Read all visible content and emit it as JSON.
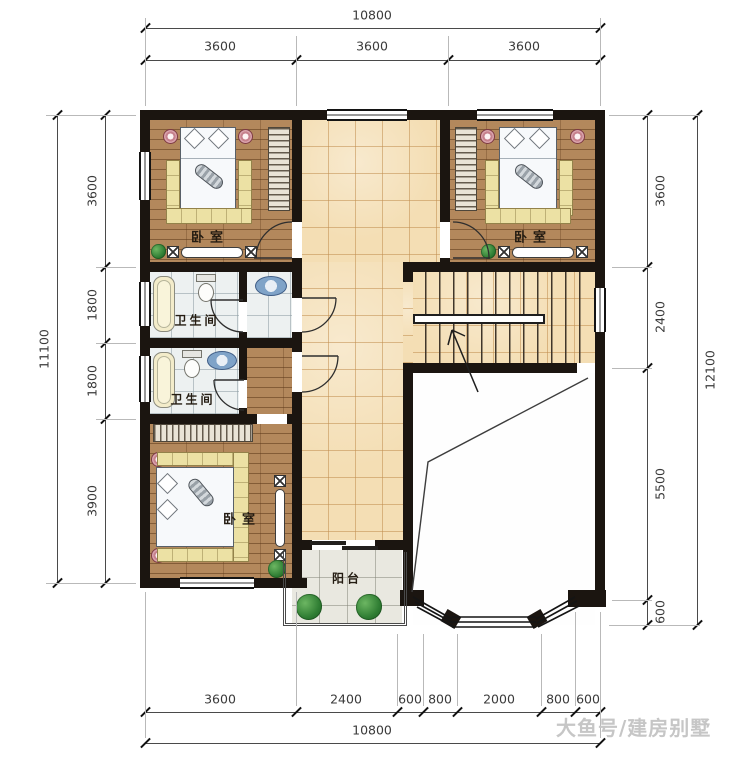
{
  "plan": {
    "title": "residential second floor plan",
    "watermark": "大鱼号/建房别墅",
    "rooms": {
      "bedroom_top_left": "卧室",
      "bedroom_top_right": "卧室",
      "bedroom_bottom_left": "卧室",
      "bathroom_upper": "卫生间",
      "bathroom_lower": "卫生间",
      "balcony": "阳台"
    },
    "dims": {
      "top": {
        "total": "10800",
        "segments": [
          "3600",
          "3600",
          "3600"
        ]
      },
      "bottom": {
        "total": "10800",
        "segments": [
          "3600",
          "2400",
          "600",
          "800",
          "2000",
          "800",
          "600"
        ]
      },
      "left": {
        "total": "11100",
        "segments": [
          "3600",
          "1800",
          "1800",
          "3900"
        ]
      },
      "right": {
        "total": "12100",
        "segments": [
          "3600",
          "2400",
          "5500",
          "600"
        ]
      }
    },
    "colors": {
      "wall": "#1b1510",
      "wood_floor": "#b3885c",
      "hall_tile": "#f4deb4",
      "bath_tile": "#edf1f1",
      "balcony_tile": "#e9e8e0",
      "bench_yellow": "#ece1a4",
      "plant_green": "#2f7d33",
      "sink_blue": "#7fa3c8"
    }
  }
}
